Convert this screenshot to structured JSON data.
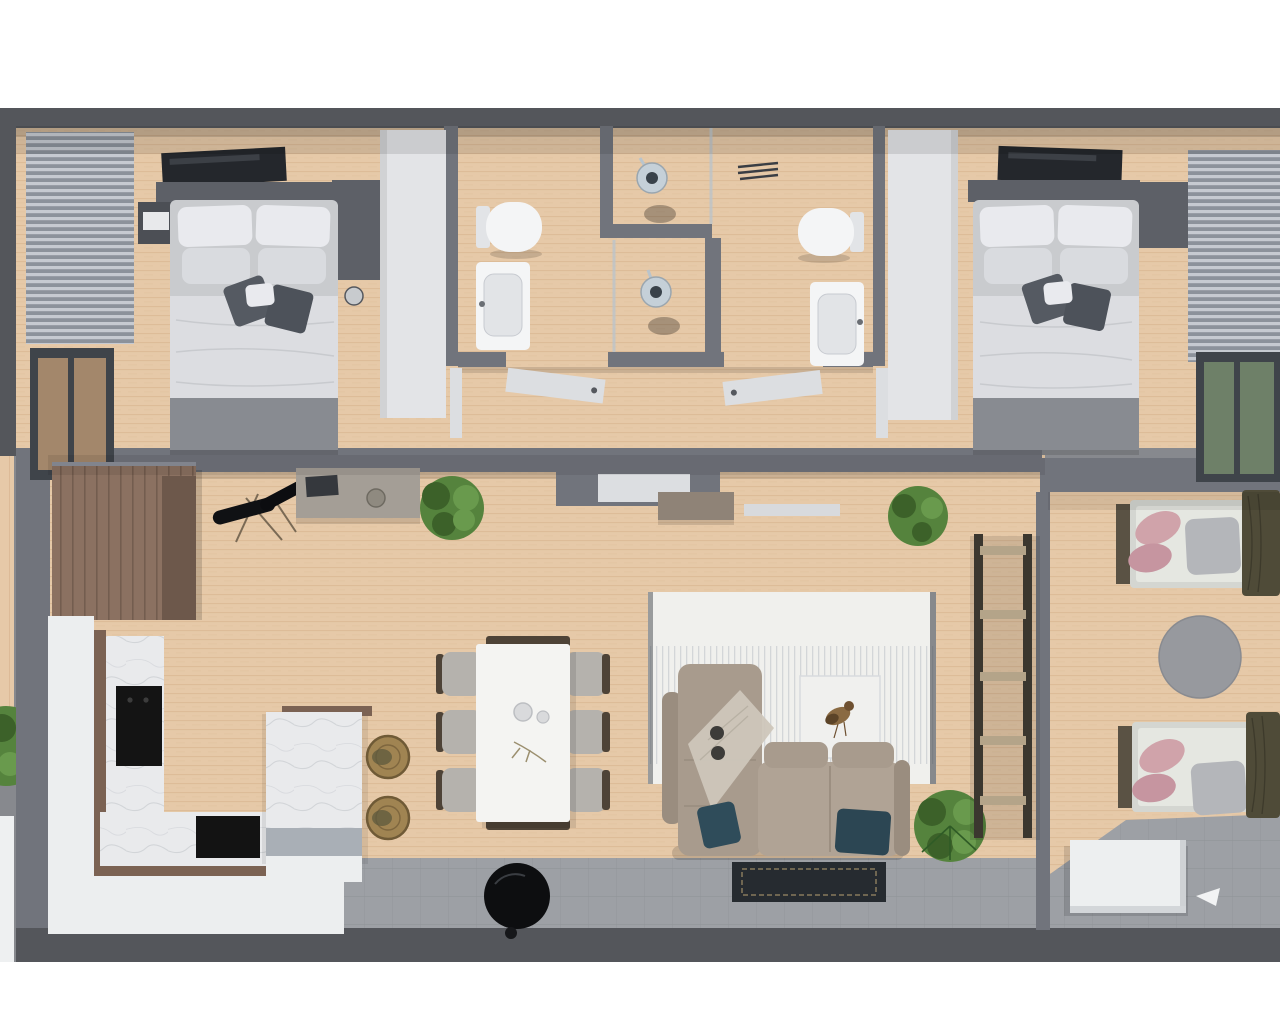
{
  "scene": {
    "title": "3D top-down apartment floor plan render",
    "rooms": [
      {
        "id": "bedroom-left",
        "label": "master bedroom left",
        "furniture": [
          "tv-panel",
          "headboard-shelf",
          "double-bed",
          "pillows",
          "accent-pillows",
          "duvet",
          "foot-blanket",
          "nightstand",
          "wardrobe",
          "window-blinds",
          "window",
          "closet-column"
        ]
      },
      {
        "id": "bathroom-left",
        "label": "bathroom left",
        "furniture": [
          "toilet",
          "washbasin",
          "shower-stall",
          "shower-head",
          "door"
        ]
      },
      {
        "id": "bathroom-right",
        "label": "bathroom right",
        "furniture": [
          "toilet",
          "washbasin",
          "shower-stall",
          "shower-head",
          "vent-grille",
          "door"
        ]
      },
      {
        "id": "bedroom-right",
        "label": "master bedroom right",
        "furniture": [
          "tv-panel",
          "headboard-shelf",
          "double-bed",
          "pillows",
          "accent-pillows",
          "duvet",
          "foot-blanket",
          "wardrobe",
          "window-blinds",
          "window",
          "closet-column"
        ]
      },
      {
        "id": "hallway",
        "label": "hallway",
        "furniture": [
          "doors"
        ]
      },
      {
        "id": "kitchen",
        "label": "kitchen",
        "furniture": [
          "tall-wood-cabinets",
          "l-counter",
          "marble-worktop",
          "cooktop",
          "oven",
          "island",
          "rattan-stools",
          "guitar-on-stand",
          "sideboard",
          "potted-plant"
        ]
      },
      {
        "id": "dining",
        "label": "dining area",
        "furniture": [
          "dining-table",
          "six-chairs",
          "plates",
          "bench-consoles"
        ]
      },
      {
        "id": "living",
        "label": "living area",
        "furniture": [
          "sectional-sofa",
          "teal-pillows",
          "throw-blanket",
          "area-rug",
          "art-panel-bird",
          "doormat",
          "robot-vacuum",
          "potted-plants",
          "ladder-shelf-divider",
          "wall-bench",
          "wall-shelf"
        ]
      },
      {
        "id": "kids-room",
        "label": "kids bedroom right",
        "furniture": [
          "single-bed-top",
          "single-bed-bottom",
          "pink-pillows",
          "gray-pillows",
          "olive-blankets",
          "round-rug",
          "white-desk"
        ]
      },
      {
        "id": "terrace",
        "label": "gray tiled terrace strip",
        "furniture": []
      }
    ]
  },
  "palette": {
    "letterbox": "#ffffff",
    "outer_bg": "#87898e",
    "wall": "#71747c",
    "wall_dark": "#54565b",
    "floor_wood": "#e6c9a8",
    "floor_wood_line": "#c49a70",
    "tile_gray": "#9da0a5",
    "tile_line": "#8e9196",
    "closet_white": "#e3e4e7",
    "fixture_white": "#f4f5f6",
    "fixture_inner": "#e2e4e7",
    "counter_white": "#eceeef",
    "marble": "#e9eaec",
    "marble_vein": "#c9ccd1",
    "wood_trim": "#7b6253",
    "wood_cabinet": "#8b7161",
    "wood_cabinet_dark": "#6d584b",
    "cabinet_lip": "#8d9099",
    "island_side": "#a9afb6",
    "stool": "#a08452",
    "stool_dark": "#6f5a36",
    "table_white": "#f4f4f2",
    "chair_seat": "#b5b2ad",
    "chair_frame": "#4e4337",
    "sofa": "#a89b8d",
    "sofa_arm": "#9a8d7f",
    "sofa_seat": "#b0a395",
    "teal_pillow": "#2f4c5a",
    "teal_pillow2": "#2c4653",
    "throw_blanket": "#cdc6ba",
    "rug": "#f0f0ed",
    "rug_fringe": "#b9bec5",
    "rug_edge": "#41454b",
    "doormat": "#262b30",
    "doormat_line": "#877a5c",
    "robot_black": "#0d0e10",
    "plant": "#55833d",
    "plant_dark": "#3c6129",
    "plant_light": "#699a4d",
    "bed_duvet": "#dcdde1",
    "bed_pillow": "#e9eaee",
    "bed_pillow2": "#d9dbdf",
    "accent_pillow": "#555a62",
    "accent_pillow2": "#4d525a",
    "bed_foot": "#888b91",
    "headboard": "#5d6067",
    "nightstand": "#4c4f55",
    "tv_panel": "#24272c",
    "blinds_light": "#c6cad1",
    "blinds_dark": "#8c929b",
    "window_frame": "#3f444a",
    "window_tan": "#a3876b",
    "window_green": "#6e8068",
    "shower_glass": "#b9c4cc",
    "shower_metal": "#c5d0d8",
    "shower_dark": "#39424a",
    "vent_dark": "#3a3e44",
    "door_white": "#dcdee1",
    "shelf_frame": "#3b372f",
    "shelf_wood": "#b4a489",
    "kids_mattress": "#e5e7e1",
    "kids_frame": "#d4d6d1",
    "kids_headboard": "#5a5244",
    "kids_pink": "#d0a3aa",
    "kids_pink2": "#c695a0",
    "kids_gray_pillow": "#b4b6ba",
    "kids_olive": "#4f4b38",
    "kids_rug": "#97999e",
    "desk_white": "#edeff0",
    "sideboard": "#a49e96",
    "bench": "#8f8377",
    "wall_shelf": "#d8dadd",
    "outside_slab": "#eef0f1"
  }
}
